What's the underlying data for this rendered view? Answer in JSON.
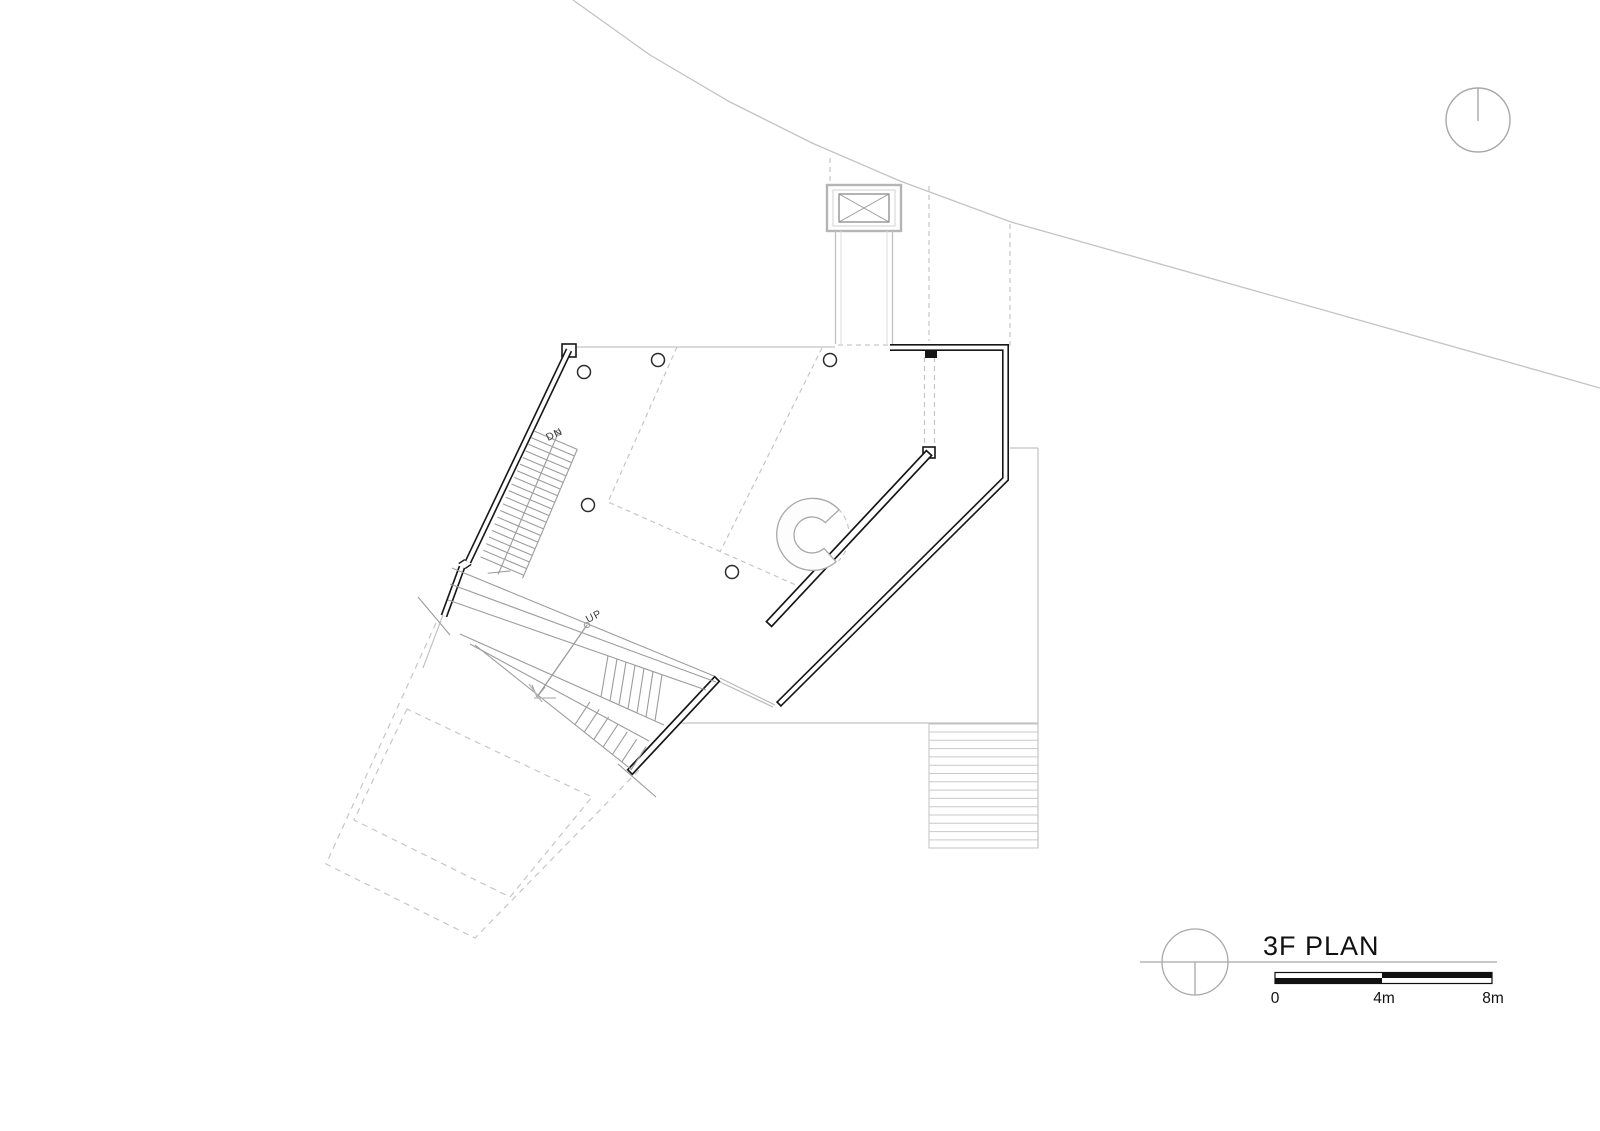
{
  "sheet": {
    "type": "architectural-floor-plan"
  },
  "title_block": {
    "title": "3F PLAN",
    "scale_bar": {
      "labels": [
        "0",
        "4m",
        "8m"
      ],
      "segment_length_m": 4
    }
  },
  "plan_labels": {
    "stair_down": "DN",
    "stair_up": "UP"
  },
  "colors": {
    "wall": "#161616",
    "site_line": "#c3c3c3",
    "stair_line": "#9c9c9c",
    "dashed_line": "#c6c6c6",
    "text": "#2b2b2b"
  }
}
